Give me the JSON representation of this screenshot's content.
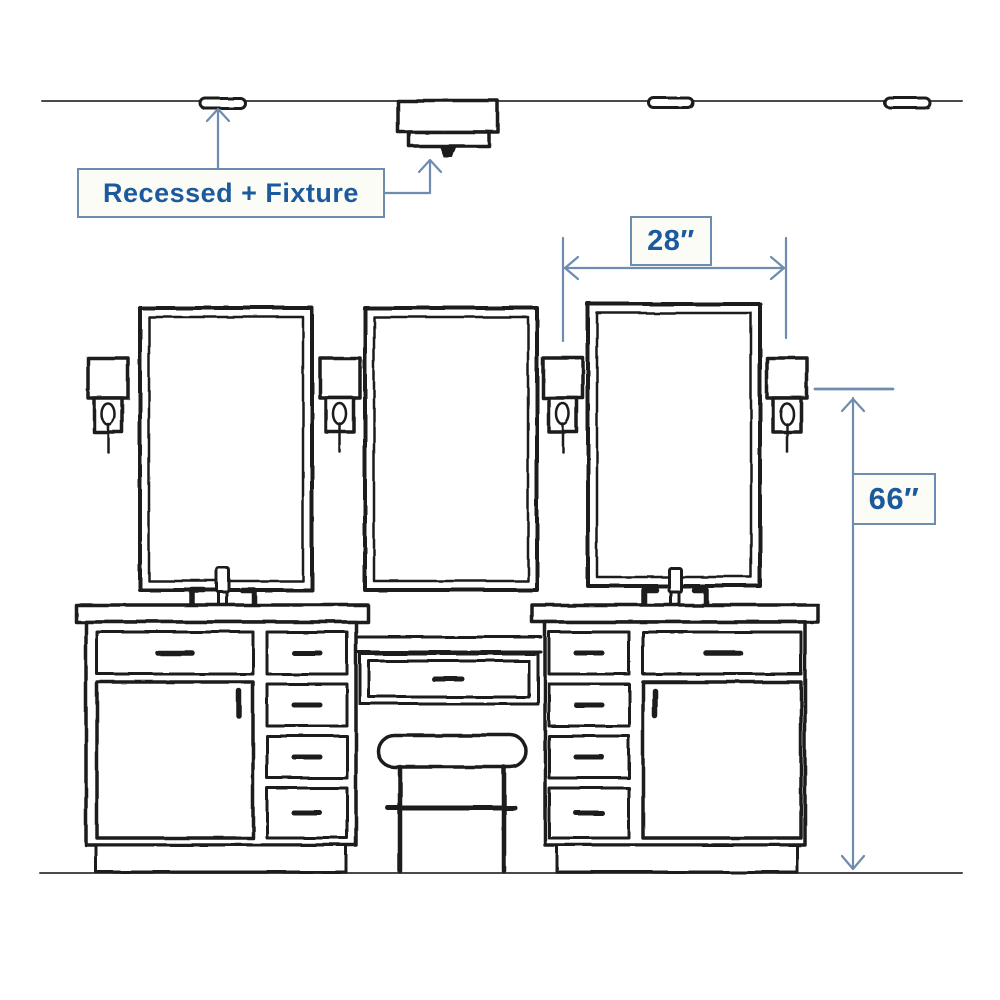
{
  "annotations": {
    "fixture_label": "Recessed + Fixture",
    "width_label": "28″",
    "height_label": "66″"
  },
  "scene": {
    "type": "bathroom-vanity-lighting-dimension-diagram",
    "elements": [
      "ceiling-line",
      "recessed-light",
      "surface-mount-fixture",
      "recessed-light",
      "recessed-light",
      "mirror",
      "mirror",
      "mirror",
      "wall-sconce",
      "wall-sconce",
      "wall-sconce",
      "wall-sconce",
      "vanity-cabinet-left",
      "makeup-knee-drawer",
      "vanity-stool",
      "vanity-cabinet-right",
      "faucet",
      "faucet",
      "floor-line"
    ],
    "dimensions": [
      {
        "label": "28″",
        "measures": "spacing-between-sconces"
      },
      {
        "label": "66″",
        "measures": "floor-to-sconce-height"
      },
      {
        "label": "Recessed + Fixture",
        "measures": "ceiling-lighting-callout"
      }
    ]
  },
  "colors": {
    "ink": "#1a1a1a",
    "structure": "#4a4a4a",
    "annotation_line": "#6d8cae",
    "annotation_text": "#1c5a9d",
    "label_bg": "#fcfcf7",
    "bg": "#ffffff"
  }
}
